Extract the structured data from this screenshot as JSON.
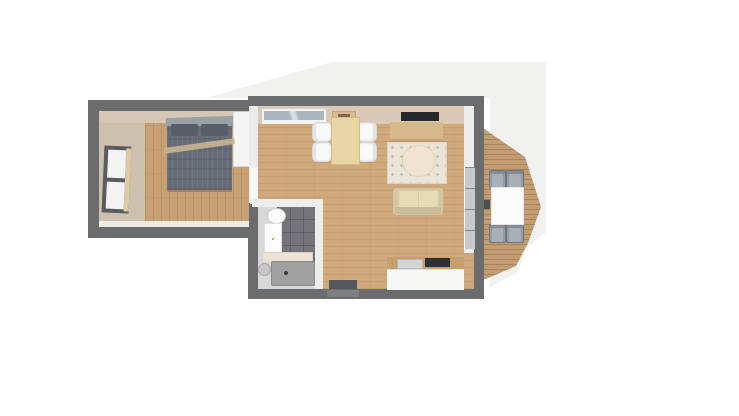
{
  "scene": {
    "type": "apartment-floor-plan-3d-top-view",
    "background": "#ffffff",
    "site_outline_color": "#f1f1ef"
  },
  "palette": {
    "outer_wall": "#6a6c6d",
    "inner_wall": "#ebebeb",
    "wall_face_beige": "#dac9b7",
    "living_wood_floor": "#cfa97b",
    "bedroom_wood_floor": "#c7a173",
    "bedroom_carpet": "#cec0ae",
    "deck_wood": "#c29d72",
    "bathroom_floor": "#d8d8d8",
    "bathroom_tile_dark": "#74747a",
    "bed_duvet": "#666c75",
    "sofa": "#d4c6a2",
    "counter_top": "#c79e6e",
    "window_glass": "#a9b5bf"
  },
  "rooms": [
    {
      "name": "Bedroom",
      "furniture": [
        "double bed",
        "wardrobe",
        "window",
        "wood floor rug"
      ]
    },
    {
      "name": "Living room / Kitchen",
      "furniture": [
        "dining table",
        "4 dining chairs",
        "window",
        "wall-mounted TV",
        "sideboard",
        "area rug",
        "round coffee table",
        "sofa",
        "kitchen counter",
        "sink",
        "cooktop",
        "doormat",
        "sliding glass door"
      ]
    },
    {
      "name": "Bathroom",
      "furniture": [
        "washbasin",
        "vanity cabinet",
        "shelf",
        "shower tray",
        "toilet"
      ]
    },
    {
      "name": "Balcony",
      "furniture": [
        "wood deck",
        "outdoor table",
        "4 outdoor chairs"
      ]
    }
  ],
  "labels": {
    "site": "Building site outline",
    "bedroom": "Bedroom",
    "living": "Living room",
    "bathroom": "Bathroom",
    "balcony": "Balcony deck",
    "bed": "Double bed",
    "headboard": "Headboard",
    "pillow": "Pillow",
    "throw": "Throw blanket",
    "wardrobe": "Wardrobe",
    "bedroom_window": "Bedroom window",
    "living_window": "Living room window",
    "tray": "Wall tray",
    "tv": "Wall-mounted TV",
    "sideboard": "Sideboard",
    "rug": "Area rug",
    "round_table": "Round coffee table",
    "sofa": "Sofa",
    "cushion": "Seat cushion",
    "dining_table": "Dining table",
    "dining_chair": "Dining chair",
    "kitchen_counter": "Kitchen counter",
    "sink": "Kitchen sink",
    "cooktop": "Cooktop",
    "doormat": "Doormat",
    "entrance": "Entrance door",
    "washbasin": "Washbasin",
    "vanity": "Vanity cabinet",
    "shelf": "Bathroom shelf",
    "shower": "Shower tray",
    "drain": "Shower drain",
    "toilet": "Toilet",
    "sliding_door": "Sliding glass door",
    "handle": "Door handle",
    "balcony_table": "Outdoor table",
    "balcony_chair": "Outdoor chair",
    "wall": "Wall",
    "partition": "Partition wall",
    "floor": "Floor"
  }
}
